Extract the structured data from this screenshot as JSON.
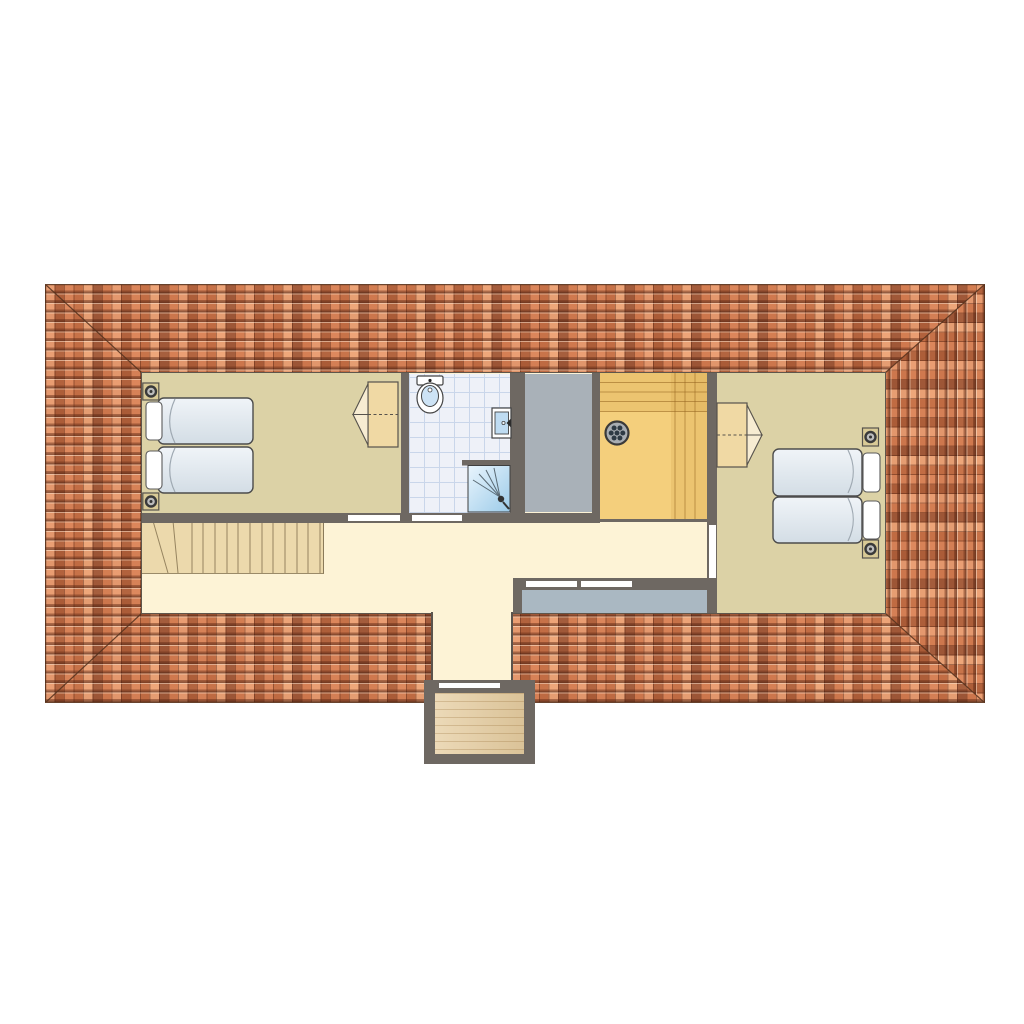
{
  "diagram_type": "floor-plan",
  "floor": "attic-level",
  "roof": {
    "shape": "hipped-rectangle",
    "covering": "terracotta-tiles",
    "tile_orientation": {
      "top_band": "horizontal-courses",
      "bottom_band": "horizontal-courses",
      "left_band": "horizontal-courses",
      "right_band": "vertical-courses"
    }
  },
  "rooms": [
    {
      "name": "bedroom-left",
      "floor_finish": "carpet-tan",
      "furniture": [
        "twin-bed",
        "twin-bed",
        "pillow",
        "pillow",
        "structural-post",
        "structural-post",
        "wardrobe-open-doors"
      ],
      "doors": [
        "door-to-hallway"
      ]
    },
    {
      "name": "bathroom",
      "floor_finish": "tile-grid",
      "furniture": [
        "toilet",
        "washbasin",
        "shower-cubicle"
      ],
      "doors": [
        "door-to-hallway"
      ]
    },
    {
      "name": "void-room",
      "floor_finish": "gray"
    },
    {
      "name": "sauna",
      "floor_finish": "wood",
      "furniture": [
        "bench-top",
        "bench-right",
        "sauna-heater"
      ]
    },
    {
      "name": "bedroom-right",
      "floor_finish": "carpet-tan",
      "furniture": [
        "twin-bed",
        "twin-bed",
        "pillow",
        "pillow",
        "structural-post",
        "structural-post",
        "wardrobe-open-doors"
      ],
      "doors": [
        "door-to-hallway"
      ]
    },
    {
      "name": "hallway",
      "floor_finish": "cream",
      "furniture": [
        "staircase-with-winders"
      ]
    },
    {
      "name": "rear-gray-band",
      "floor_finish": "gray-blue",
      "windows": [
        "window-1",
        "window-2"
      ]
    },
    {
      "name": "corridor",
      "floor_finish": "cream"
    },
    {
      "name": "balcony",
      "floor_finish": "wood-deck",
      "doors": [
        "balcony-door"
      ]
    }
  ],
  "counts": {
    "beds": 4,
    "wardrobes": 2,
    "structural_posts": 4,
    "door_thresholds": 4,
    "rear_windows": 2,
    "stair_treads": 14
  },
  "colors": {
    "roof_base": "#c8784e",
    "roofline": "#53301c",
    "wall": "#6e6862",
    "hall_floor": "#fdf3d6",
    "bedroom_floor": "#dcd2a6",
    "bath_floor": "#eef1f8",
    "bath_grid": "#c9d6ea",
    "void_floor": "#a9b1b8",
    "band_floor": "#aab8c2",
    "sauna_floor": "#f4cf7c",
    "bench_line": "#96651f",
    "stairs_floor": "#ecd9ac",
    "balcony_wood": "#e6cda0",
    "bed_light": "#f0f4f8",
    "bed_dark": "#d3dde5",
    "pillow": "#ffffff",
    "cabinet_wood": "#f0d9a4",
    "post_fill": "#d9ca96",
    "shower_light": "#e9f5fd",
    "shower_dark": "#9ccbe9",
    "heater_body": "#a8adb2",
    "heater_stone": "#2e3a44",
    "threshold": "#ffffff"
  }
}
